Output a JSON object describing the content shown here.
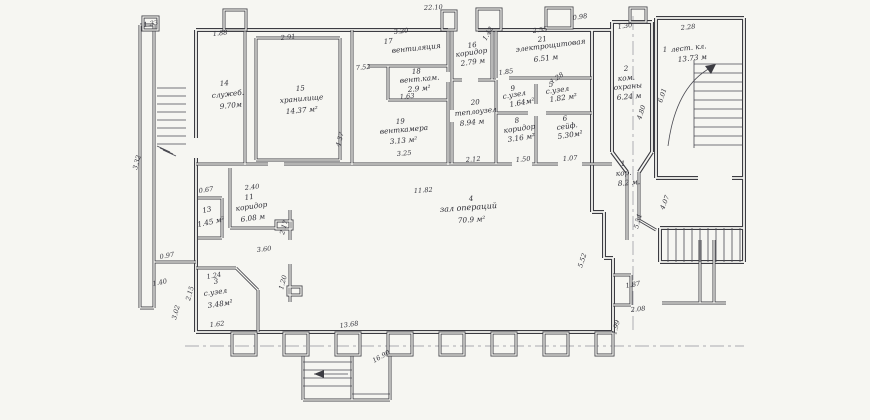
{
  "plan": {
    "type": "scanned architectural floor plan",
    "colors": {
      "paper": "#f6f6f2",
      "line": "#3c3c42",
      "text": "#2b2b33"
    },
    "rooms": {
      "r1stair": {
        "num": "1",
        "name": "лест. кл.",
        "area": "13.73 м"
      },
      "r1kor": {
        "num": "1",
        "name": "кор.",
        "area": "8.2 м."
      },
      "r2": {
        "num": "2",
        "name1": "ком.",
        "name2": "охраны",
        "area": "6.24 м"
      },
      "r3": {
        "num": "3",
        "name": "с.узел",
        "area": "3.48м²"
      },
      "r4": {
        "num": "4",
        "name": "зал операций",
        "area": "70.9 м²"
      },
      "r5": {
        "num": "5",
        "name": "с.узел",
        "area": "1.82 м²"
      },
      "r6": {
        "num": "6",
        "name": "сейф.",
        "area": "5.30м²"
      },
      "r8": {
        "num": "8",
        "name": "коридор",
        "area": "3.16 м²"
      },
      "r9": {
        "num": "9",
        "name": "с.узел",
        "area": "1.64м²"
      },
      "r11": {
        "num": "11",
        "name": "коридор",
        "area": "6.08 м"
      },
      "r13": {
        "num": "13",
        "area": "1.45 м²"
      },
      "r14": {
        "num": "14",
        "name": "служеб.",
        "area": "9.70м"
      },
      "r15": {
        "num": "15",
        "name": "хранилище",
        "area": "14.37 м²"
      },
      "r16": {
        "num": "16",
        "name": "коридор",
        "area": "2.79 м"
      },
      "r17": {
        "num": "17",
        "name": "вентиляция"
      },
      "r18": {
        "num": "18",
        "name": "вент.кам.",
        "area": "2.9 м²"
      },
      "r19": {
        "num": "19",
        "name": "венткамера",
        "area": "3.13 м²"
      },
      "r20": {
        "num": "20",
        "name": "теплоузел",
        "area": "8.94 м"
      },
      "r21": {
        "num": "21",
        "name": "электрощитовая",
        "area": "6.51 м"
      }
    },
    "dims": {
      "top_overall": "22.10",
      "pier_left": "1.33",
      "r14_w": "1.88",
      "r15_w": "2.91",
      "r17_w": "3.20",
      "r21_w": "2.55",
      "top_098": "0.98",
      "r2_w": "1.30",
      "stair_w": "2.28",
      "vent_752": "7.52",
      "d163": "1.63",
      "d325": "3.25",
      "vault_h": "4.37",
      "d142": "1.42",
      "d185": "1.85",
      "d128": "1.28",
      "d150": "1.50",
      "d107": "1.07",
      "d212": "2.12",
      "hall_w": "11.82",
      "hall_552": "5.52",
      "d067": "0.67",
      "d240": "2.40",
      "d360": "3.60",
      "d217": "2.17",
      "d120": "1.20",
      "d124": "1.24",
      "d215": "2.15",
      "d162": "1.62",
      "d097": "0.97",
      "d140": "1.40",
      "left_h": "3.32",
      "d302": "3.02",
      "bottom_1368": "13.68",
      "bottom_1690": "16.90",
      "r2_h": "4.80",
      "stair_h": "6.01",
      "d554": "5.54",
      "d407": "4.07",
      "d187": "1.87",
      "d208": "2.08",
      "d199": "1.99"
    }
  }
}
